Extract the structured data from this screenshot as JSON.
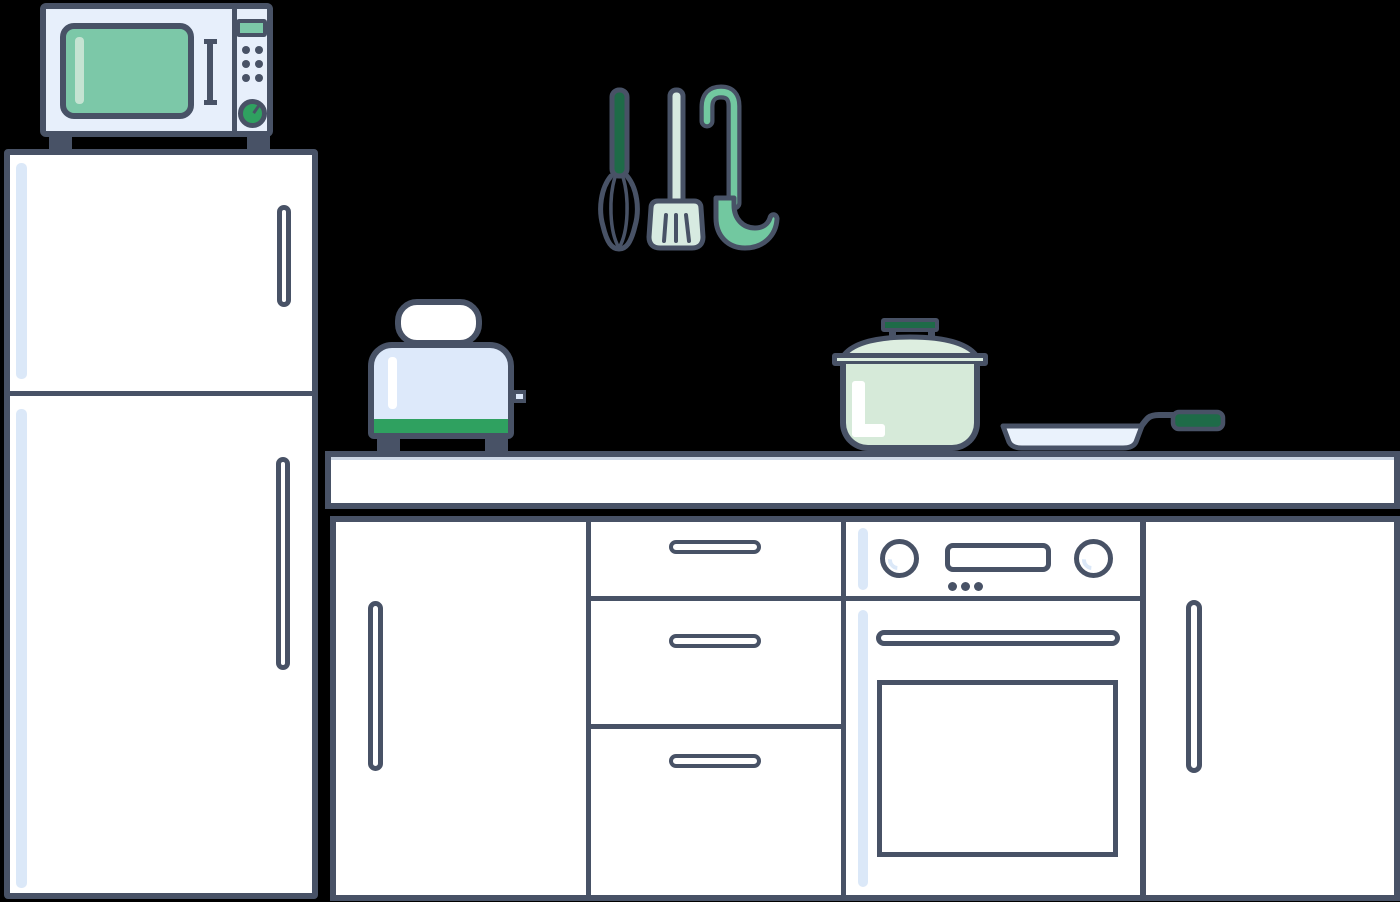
{
  "canvas": {
    "width": 1400,
    "height": 902,
    "background": "#000000"
  },
  "colors": {
    "background": "#000000",
    "outline": "#485266",
    "white": "#ffffff",
    "panel-blue": "#e7effb",
    "toaster-blue": "#dde9fa",
    "pan-blue": "#eaf2fc",
    "highlight-blue": "#dbe8f8",
    "green-window": "#7cc8a8",
    "green-window-highlight": "#c5e3d2",
    "green-accent": "#2fa160",
    "green-dark": "#1e6b48",
    "green-ladle": "#72c8a0",
    "mint-pale": "#d7eae1",
    "mint-pot": "#d6ead9",
    "mint-lid": "#ddeee0"
  },
  "scene_objects": [
    {
      "name": "microwave",
      "parts": [
        "green-window",
        "door-handle",
        "green-display",
        "six-control-dots",
        "green-dial-knob",
        "two-feet"
      ]
    },
    {
      "name": "refrigerator",
      "parts": [
        "upper-door",
        "lower-door",
        "two-vertical-handles",
        "two-light-stripes"
      ]
    },
    {
      "name": "hanging-utensils",
      "parts": [
        "whisk-green-handle",
        "slotted-spatula",
        "green-ladle"
      ]
    },
    {
      "name": "toaster",
      "parts": [
        "bread-slice",
        "light-blue-body",
        "green-base-band",
        "side-lever",
        "two-feet"
      ]
    },
    {
      "name": "cooking-pot",
      "parts": [
        "lid-knob-bar",
        "lid-dome",
        "lid-rim",
        "mint-body",
        "L-highlight"
      ]
    },
    {
      "name": "frying-pan",
      "parts": [
        "shallow-dish",
        "bent-handle",
        "green-grip"
      ]
    },
    {
      "name": "countertop",
      "parts": []
    },
    {
      "name": "cabinet-row",
      "parts": [
        "left-door",
        "drawer-stack-of-3",
        "oven-cabinet",
        "right-door"
      ]
    },
    {
      "name": "oven",
      "parts": [
        "left-knob",
        "right-knob",
        "display",
        "three-dots",
        "door-handle",
        "door-window"
      ]
    }
  ]
}
